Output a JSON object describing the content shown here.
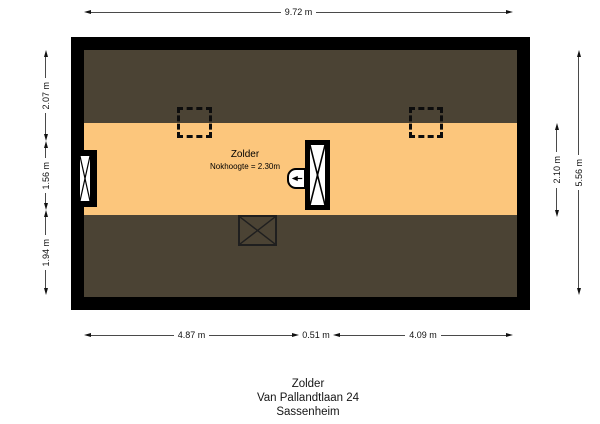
{
  "colors": {
    "canvas-bg": "#ffffff",
    "wall": "#000000",
    "roof-area": "#4b4334",
    "floor-area": "#fcc67c",
    "dim-line": "#4a4a4a",
    "dim-text": "#111111"
  },
  "plan": {
    "room": {
      "name": "Zolder",
      "note": "Nokhoogte = 2.30m"
    },
    "symbols": {
      "skylight_left": "roof-window-dashed-outline",
      "skylight_right": "roof-window-dashed-outline",
      "left_window": "wall-window-cross",
      "staircase": "staircase-opening-cross",
      "staircase_entry": "arrow-left",
      "hatch": "crossed-box"
    }
  },
  "dimensions": {
    "top": {
      "width": "9.72 m"
    },
    "left": {
      "seg1": "2.07 m",
      "seg2": "1.56 m",
      "seg3": "1.94 m"
    },
    "right": {
      "inner": "2.10 m",
      "outer": "5.56 m"
    },
    "bottom": {
      "seg1": "4.87 m",
      "seg2": "0.51 m",
      "seg3": "4.09 m"
    }
  },
  "caption": {
    "room": "Zolder",
    "address": "Van Pallandtlaan 24",
    "city": "Sassenheim"
  }
}
